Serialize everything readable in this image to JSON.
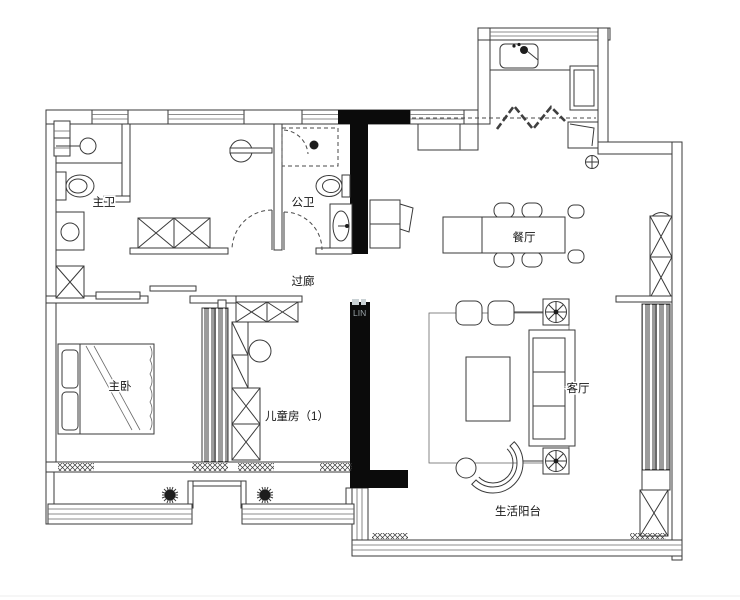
{
  "rooms": {
    "master_bath": "主卫",
    "public_bath": "公卫",
    "corridor": "过廊",
    "dining": "餐厅",
    "master_bedroom": "主卧",
    "kids_room": "儿童房（1）",
    "living": "客厅",
    "balcony": "生活阳台"
  },
  "watermark": "LIN",
  "colors": {
    "structural_wall": "#0b0b0b",
    "line": "#3a3a3a",
    "background": "#ffffff"
  }
}
